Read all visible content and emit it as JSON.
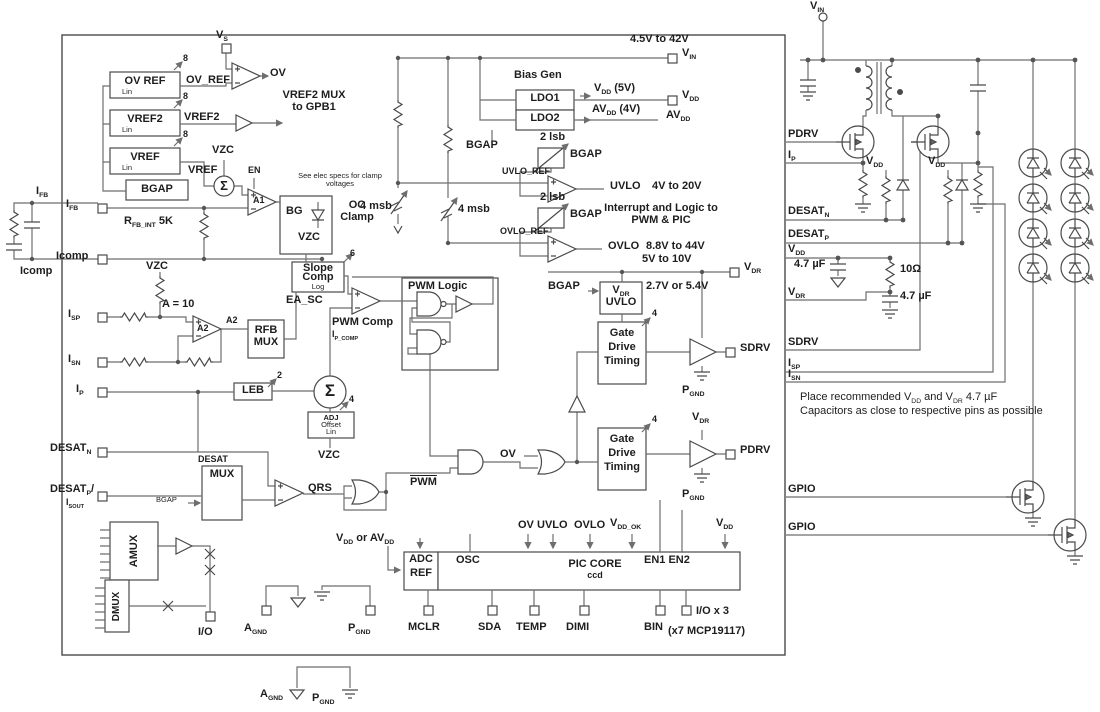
{
  "colors": {
    "wire": "#6e6e6e",
    "ink": "#1d1d1d",
    "block": "#4a4a4a"
  },
  "chip": {
    "refs": {
      "ov_ref": "OV REF",
      "vref2": "VREF2",
      "vref": "VREF",
      "lin": "Lin",
      "bgap": "BGAP",
      "bus8": "8",
      "vs": "V_{S}",
      "ov_ref_sig": "OV_REF",
      "ov_out": "OV",
      "vref2_sig": "VREF2",
      "mux_note": "VREF2 MUX to GPB1",
      "vref_sig": "VREF",
      "vzc": "VZC",
      "en": "EN",
      "a1": "A1",
      "sigma": "Σ",
      "clamp_note": "See elec specs for clamp voltages",
      "bg": "BG",
      "oc_clamp": "OC Clamp"
    },
    "fb": {
      "ifb": "I_{FB}",
      "rfb": "R_{FB_INT} 5K",
      "icomp": "Icomp",
      "isp": "I_{SP}",
      "isn": "I_{SN}",
      "ip": "I_{P}",
      "gain": "A = 10",
      "a2": "A2",
      "rfb_mux_1": "RFB",
      "rfb_mux_2": "MUX",
      "leb": "LEB",
      "bus2": "2",
      "ip_comp": "I_{P_COMP}",
      "bus4": "4",
      "adj1": "ADJ",
      "adj2": "Offset",
      "adj3": "Lin",
      "desat_n": "DESAT_{N}",
      "desat_p": "DESAT_{P}/",
      "isout": "I_{SOUT}",
      "desat": "DESAT",
      "mux": "MUX",
      "qrs": "QRS",
      "amux": "AMUX",
      "dmux": "DMUX"
    },
    "pwm": {
      "slope1": "Slope",
      "slope2": "Comp",
      "slope3": "Log",
      "bus6": "6",
      "ea_sc": "EA_SC",
      "pwm_comp": "PWM Comp",
      "pwm_logic": "PWM Logic",
      "pwm_bar": "PWM",
      "ov": "OV"
    },
    "bias": {
      "vin_range": "4.5V to 42V",
      "vin": "V_{IN}",
      "bias_gen": "Bias Gen",
      "ldo1": "LDO1",
      "ldo2": "LDO2",
      "vdd_5v": "V_{DD} (5V)",
      "avdd_4v": "AV_{DD} (4V)",
      "vdd": "V_{DD}",
      "avdd": "AV_{DD}",
      "bgap": "BGAP",
      "lsb2": "2 lsb",
      "uvlo_ref": "UVLO_REF",
      "ovlo_ref": "OVLO_REF",
      "msb4": "4 msb",
      "uvlo": "UVLO",
      "uvlo_range": "4V to 20V",
      "int_note1": "Interrupt and Logic to",
      "int_note2": "PWM & PIC",
      "ovlo": "OVLO",
      "ovlo_range": "8.8V to 44V",
      "vdr_range": "5V to 10V",
      "vdr": "V_{DR}",
      "vdr_uvlo1": "V_{DR}",
      "vdr_uvlo2": "UVLO",
      "vdr_sel": "2.7V or 5.4V"
    },
    "gd": {
      "gdt1": "Gate",
      "gdt2": "Drive",
      "gdt3": "Timing",
      "bus4": "4",
      "sdrv": "SDRV",
      "pdrv": "PDRV",
      "pgnd": "P_{GND}",
      "vdr": "V_{DR}"
    },
    "pic": {
      "adc": "ADC",
      "ref": "REF",
      "vdd_or_avdd": "V_{DD} or AV_{DD}",
      "osc": "OSC",
      "core": "PIC CORE",
      "ccd": "ccd",
      "en": "EN1 EN2",
      "ov": "OV",
      "uvlo": "UVLO",
      "ovlo": "OVLO",
      "vdd_ok": "V_{DD_OK}",
      "vdd": "V_{DD}",
      "io": "I/O",
      "agnd": "A_{GND}",
      "pgnd": "P_{GND}",
      "mclr": "MCLR",
      "sda": "SDA",
      "temp": "TEMP",
      "dimi": "DIMI",
      "bin": "BIN",
      "iox3": "I/O x 3",
      "mcp": "(x7 MCP19117)"
    }
  },
  "external": {
    "vin": "V_{IN}",
    "pdrv": "PDRV",
    "ip": "I_{P}",
    "desat_n": "DESAT_{N}",
    "desat_p": "DESAT_{P}",
    "vdd": "V_{DD}",
    "cap": "4.7 µF",
    "r10": "10Ω",
    "vdr": "V_{DR}",
    "sdrv": "SDRV",
    "isp": "I_{SP}",
    "isn": "I_{SN}",
    "gpio": "GPIO",
    "note1": "Place recommended V_{DD} and V_{DR} 4.7 µF",
    "note2": "Capacitors as close to respective pins as possible"
  },
  "legend": {
    "agnd": "A_{GND}",
    "pgnd": "P_{GND}"
  }
}
